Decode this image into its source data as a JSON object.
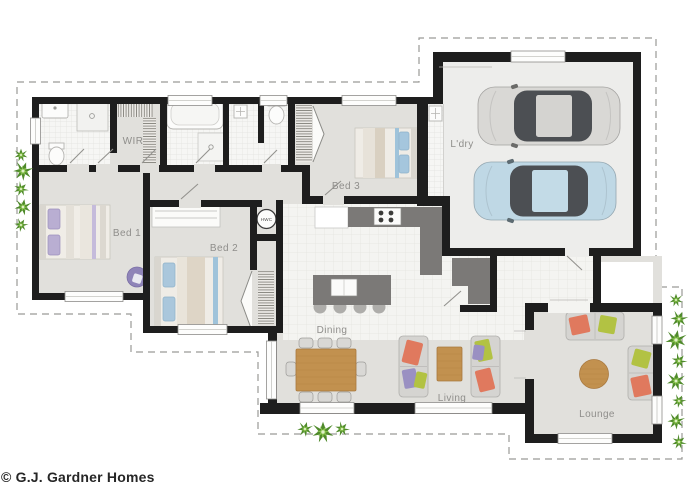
{
  "footer": {
    "credit": "© G.J. Gardner Homes"
  },
  "rooms": {
    "wir": "WIR",
    "bed1": "Bed 1",
    "bed2": "Bed 2",
    "bed3": "Bed 3",
    "laundry": "L'dry",
    "hwc": "HWC",
    "dining": "Dining",
    "living": "Living",
    "lounge": "Lounge"
  },
  "colors": {
    "wall": "#1e1e1e",
    "counter": "#7b7977",
    "wood": "#c2914f",
    "car_silver": "#d9d8d5",
    "car_blue": "#bfd8e5",
    "glass": "#4c4f53",
    "cushion_red": "#e0795e",
    "cushion_green": "#b2c243",
    "cushion_purple": "#9a90c2",
    "plant_dark": "#4f8a2b",
    "plant_light": "#86c14a"
  }
}
